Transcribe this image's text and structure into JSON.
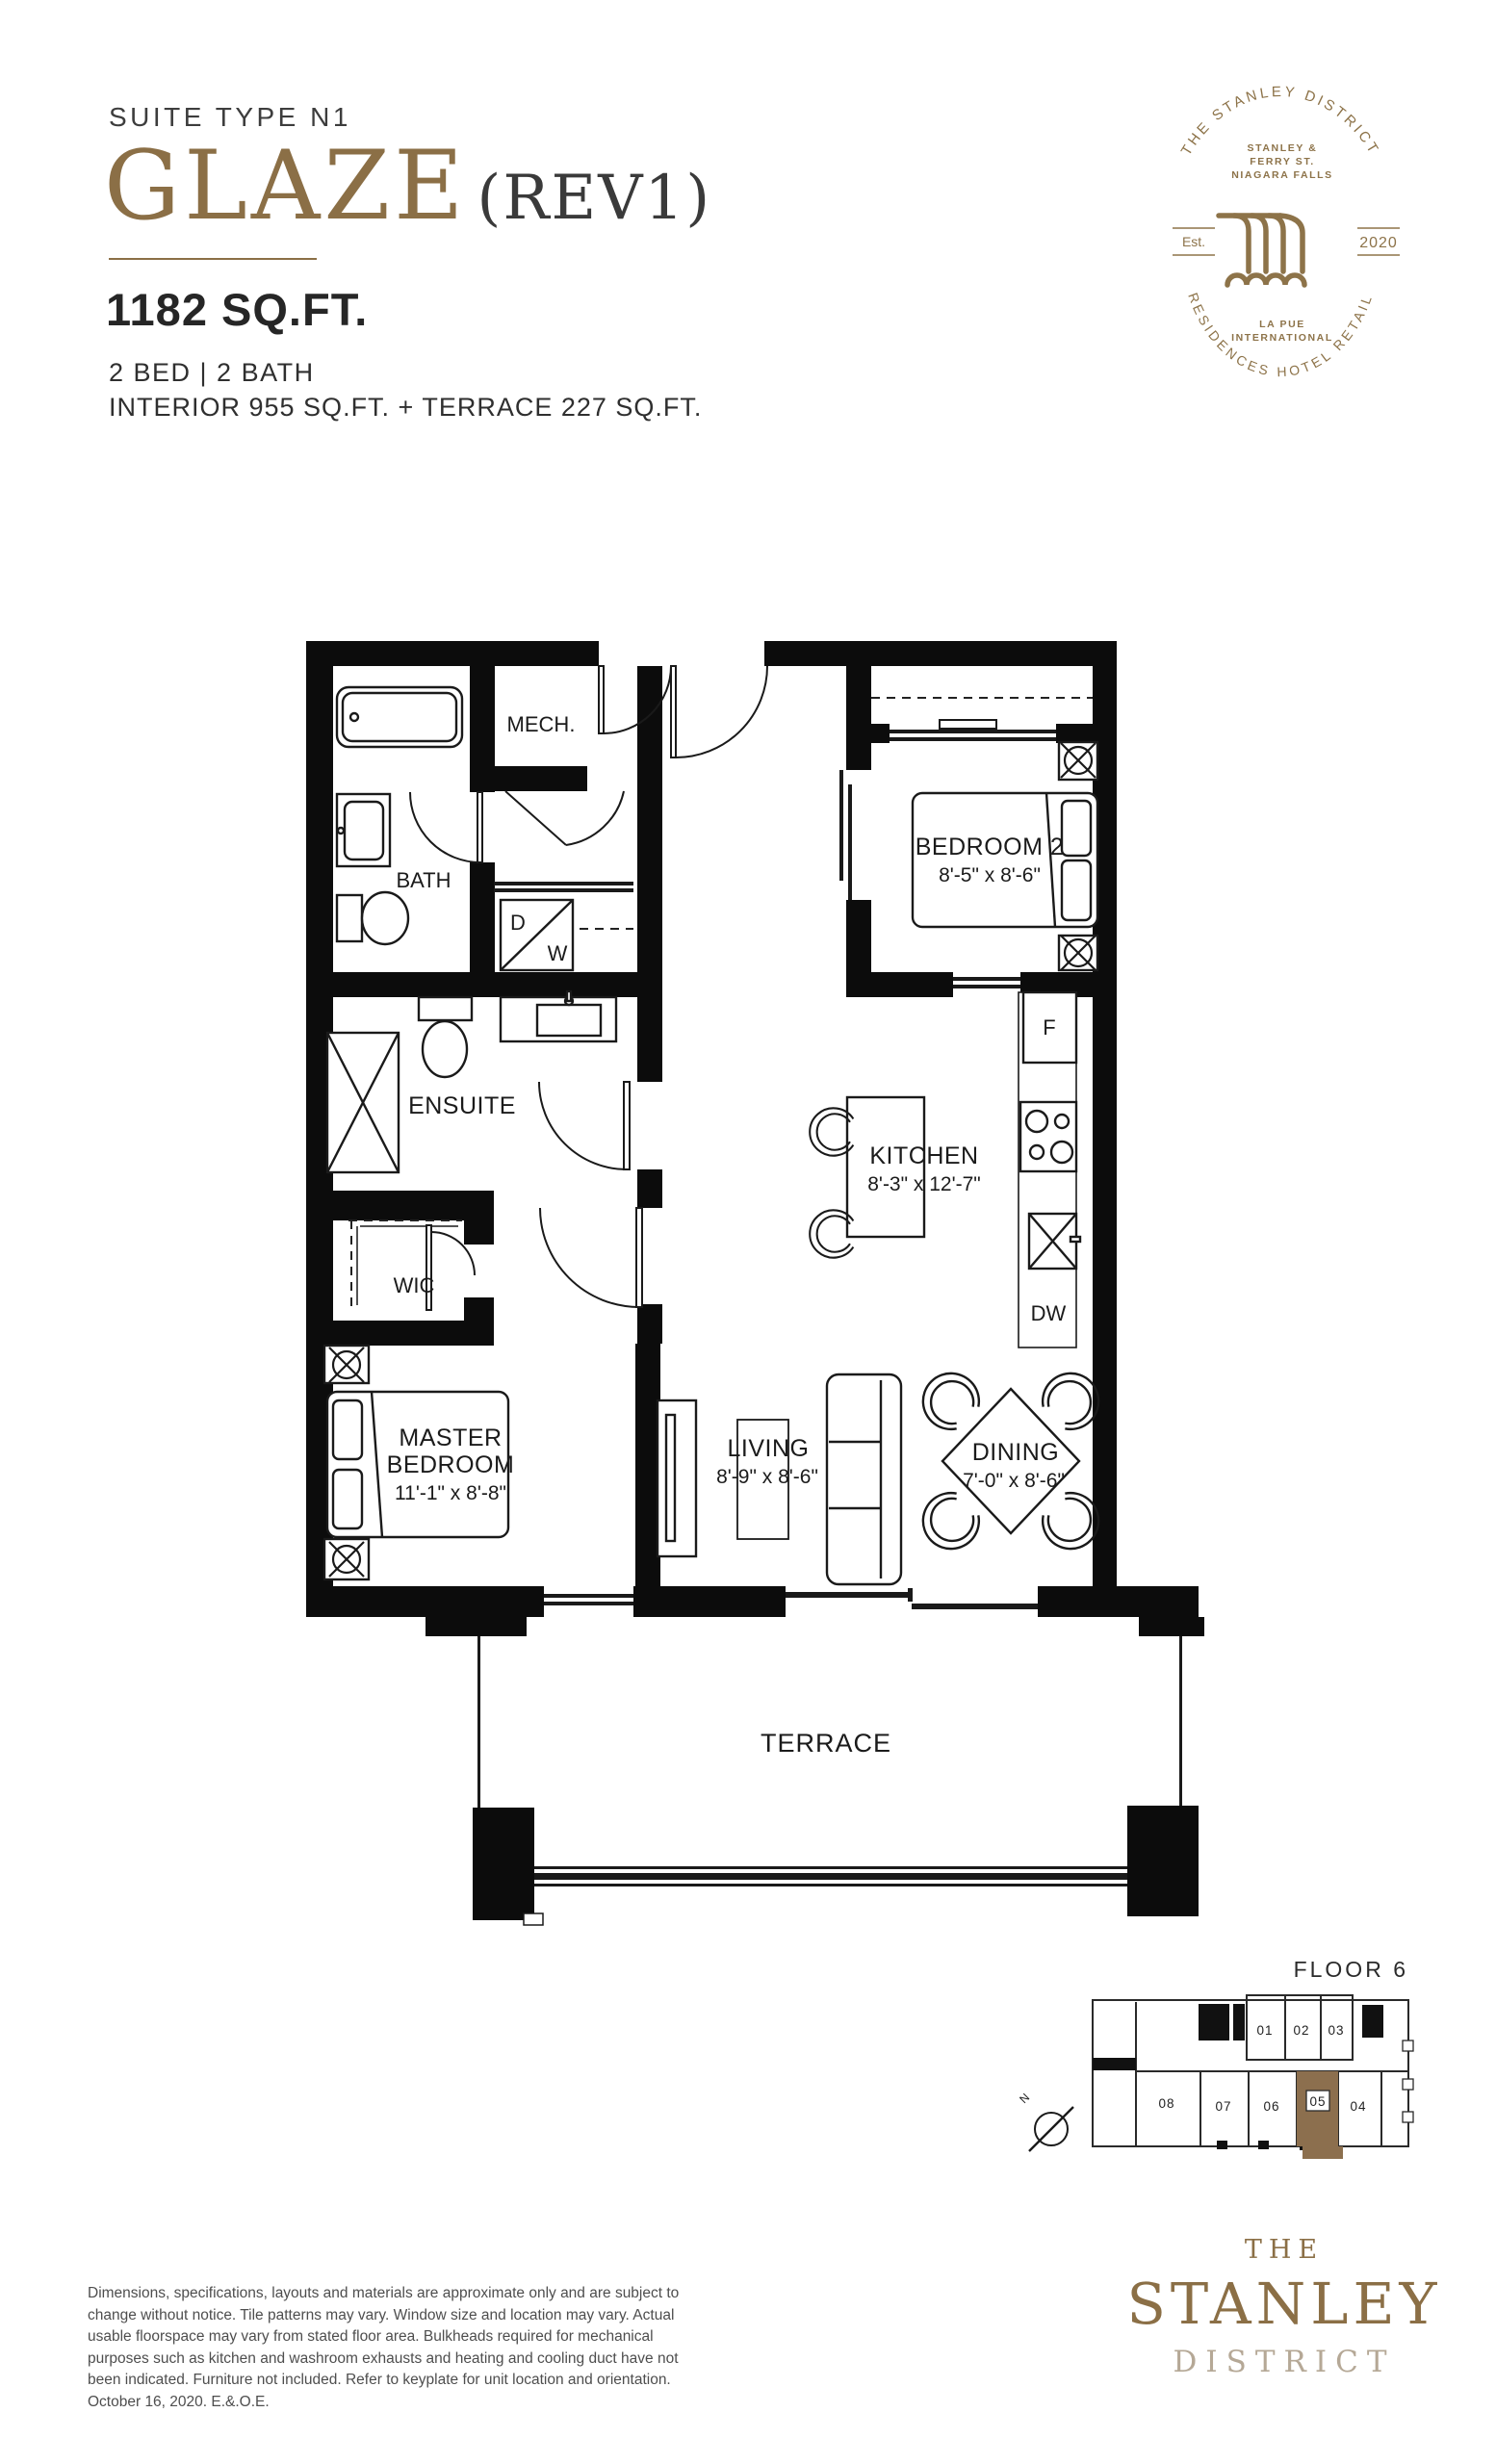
{
  "header": {
    "suite_type": "SUITE TYPE N1",
    "plan_name": "GLAZE",
    "plan_rev": "(REV1)",
    "area_total": "1182 SQ.FT.",
    "bed_bath": "2 BED  |  2 BATH",
    "area_breakdown": "INTERIOR 955 SQ.FT. + TERRACE 227 SQ.FT."
  },
  "badge": {
    "arc_top": "THE STANLEY DISTRICT",
    "address_line1": "STANLEY &",
    "address_line2": "FERRY ST.",
    "address_line3": "NIAGARA FALLS",
    "est_label": "Est.",
    "year": "2020",
    "brand_line1": "LA PUE",
    "brand_line2": "INTERNATIONAL",
    "arc_bottom": "RESIDENCES  HOTEL  RETAIL",
    "gold": "#8d7349"
  },
  "plan": {
    "rooms": {
      "mech": {
        "label": "MECH."
      },
      "bath": {
        "label": "BATH"
      },
      "bedroom2": {
        "label": "BEDROOM 2",
        "dims": "8'-5\" x 8'-6\""
      },
      "ensuite": {
        "label": "ENSUITE"
      },
      "wic": {
        "label": "WIC"
      },
      "kitchen": {
        "label": "KITCHEN",
        "dims": "8'-3\" x 12'-7\""
      },
      "master": {
        "label1": "MASTER",
        "label2": "BEDROOM",
        "dims": "11'-1\" x 8'-8\""
      },
      "living": {
        "label": "LIVING",
        "dims": "8'-9\" x 8'-6\""
      },
      "dining": {
        "label": "DINING",
        "dims": "7'-0\" x 8'-6\""
      },
      "terrace": {
        "label": "TERRACE"
      }
    },
    "appliances": {
      "fridge": "F",
      "dishwasher": "DW",
      "dryer": "D",
      "washer": "W"
    }
  },
  "keyplate": {
    "title": "FLOOR 6",
    "units": [
      "01",
      "02",
      "03",
      "04",
      "05",
      "06",
      "07",
      "08"
    ],
    "highlighted_unit": "05",
    "north_label": "N",
    "highlight_color": "#8c6f4e"
  },
  "footer": {
    "disclaimer_lines": [
      "Dimensions, specifications, layouts and materials are approximate only and are subject to",
      "change without notice. Tile patterns may vary. Window size and location may vary. Actual",
      "usable floorspace may vary from stated floor area. Bulkheads required for mechanical",
      "purposes such as kitchen and washroom exhausts and heating and cooling duct have not",
      "been indicated. Furniture not included. Refer to keyplate for unit location and orientation.",
      "October 16, 2020. E.&.O.E."
    ],
    "wordmark": {
      "line1": "THE",
      "line2": "STANLEY",
      "line3": "DISTRICT"
    }
  }
}
